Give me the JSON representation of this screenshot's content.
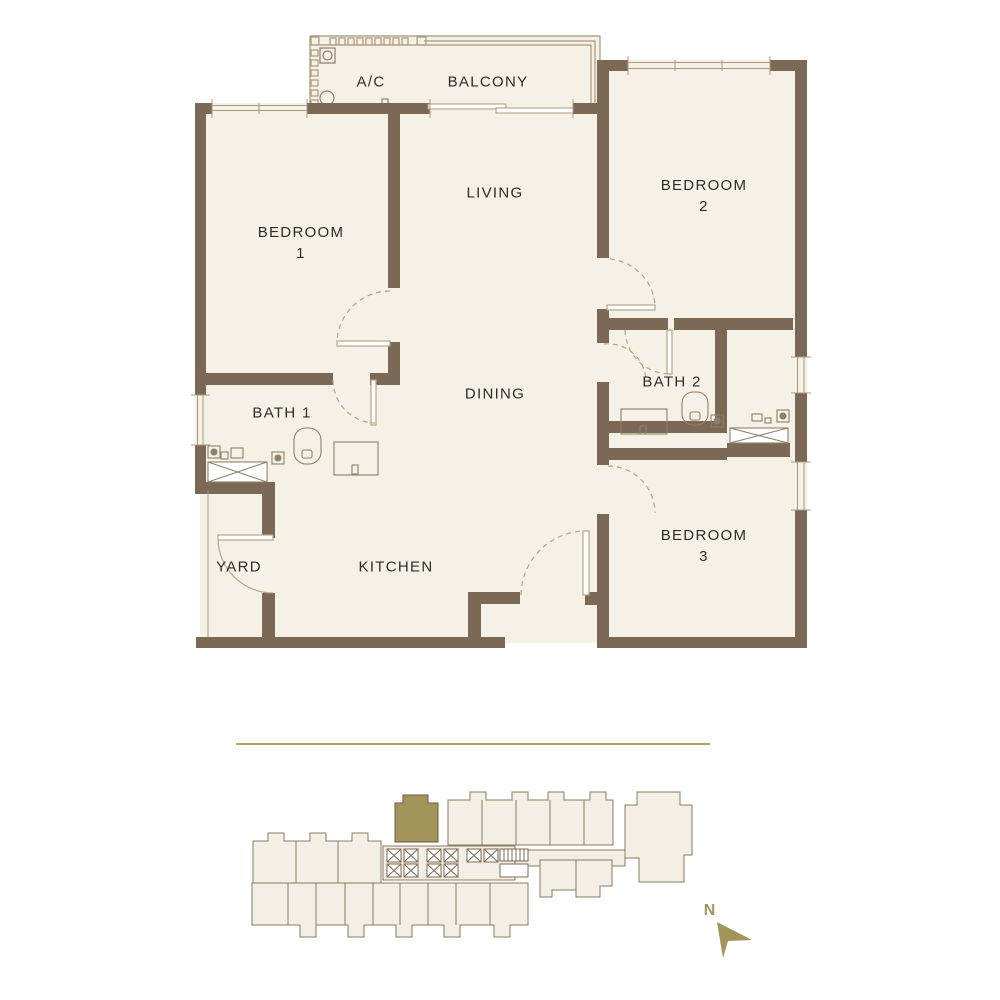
{
  "floor_plan": {
    "labels": {
      "ac": "A/C",
      "balcony": "BALCONY",
      "living": "LIVING",
      "dining": "DINING",
      "kitchen": "KITCHEN",
      "yard": "YARD",
      "bath1": "BATH 1",
      "bath2": "BATH 2",
      "bedroom1_name": "BEDROOM",
      "bedroom1_num": "1",
      "bedroom2_name": "BEDROOM",
      "bedroom2_num": "2",
      "bedroom3_name": "BEDROOM",
      "bedroom3_num": "3"
    }
  },
  "site_plan": {
    "north_label": "N"
  },
  "colors": {
    "wall_brown": "#7b6956",
    "floor_cream": "#f5f1e7",
    "thin_line": "#a89a7c",
    "accent_gold": "#a3945c",
    "site_fill": "#f3efe4",
    "text": "#2d2c2a"
  }
}
